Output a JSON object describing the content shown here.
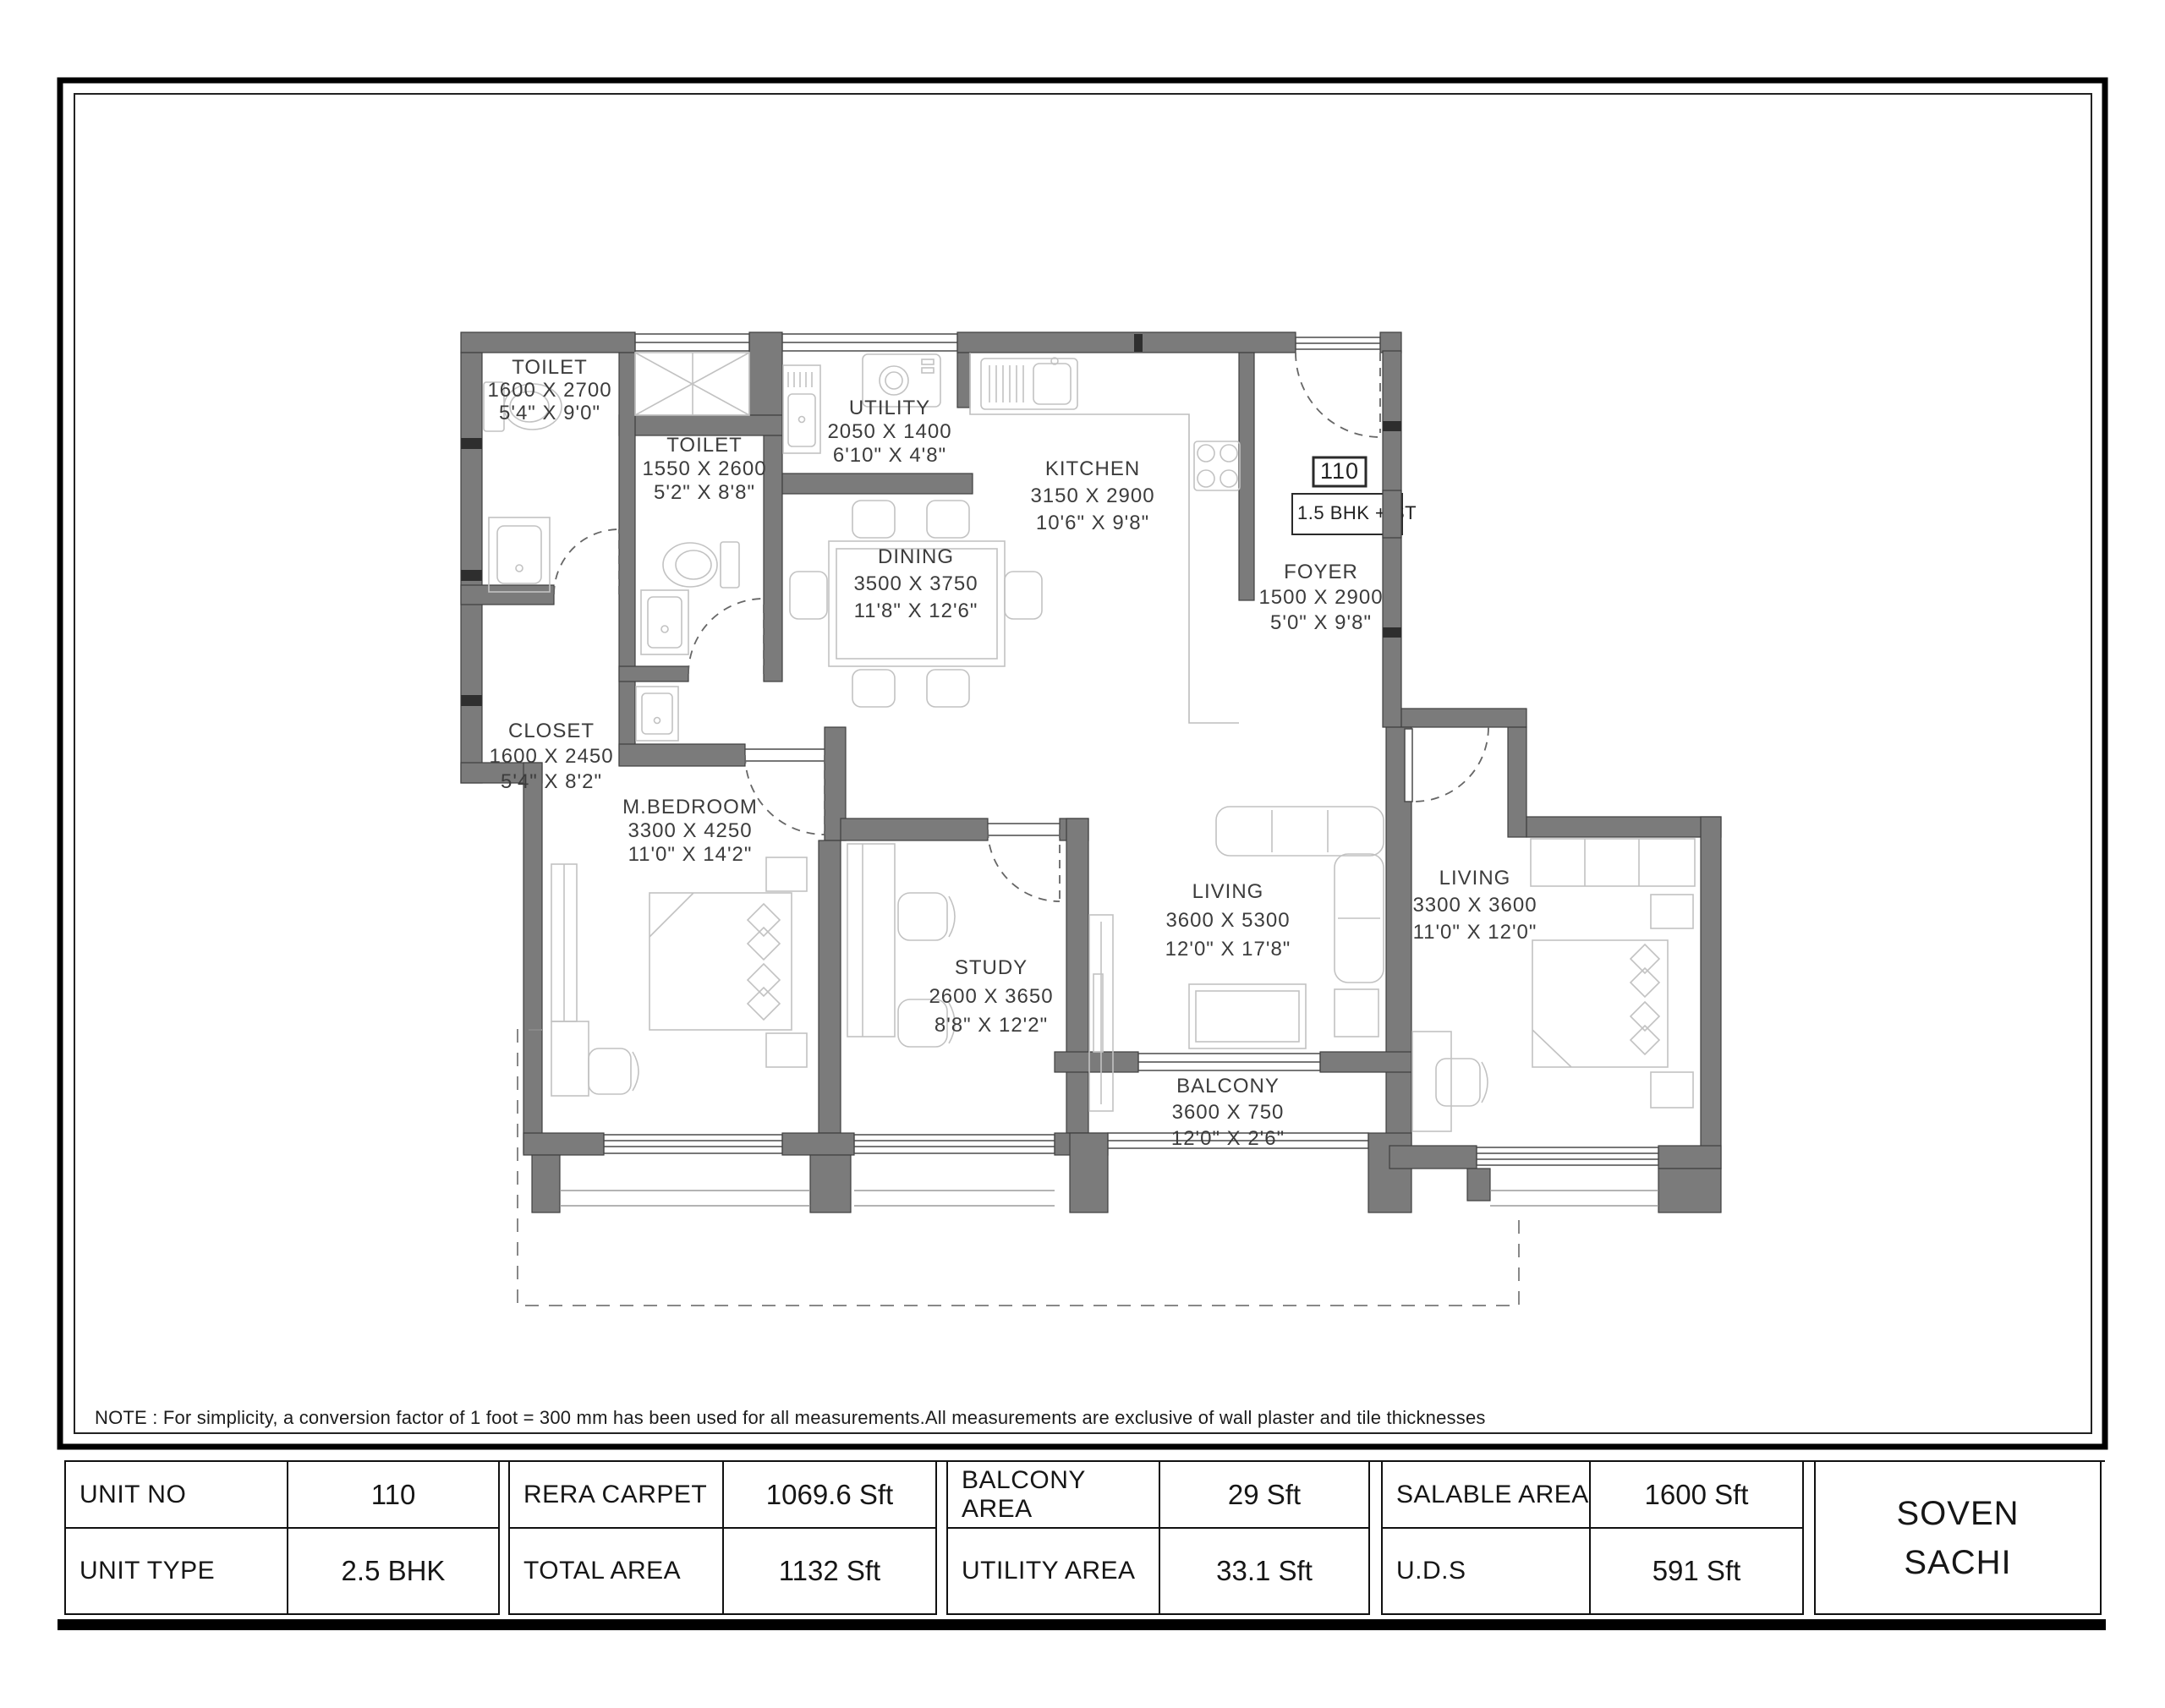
{
  "plan": {
    "unit_badge": "110",
    "unit_config": "1.5 BHK + ST",
    "rooms": [
      {
        "name": "TOILET",
        "size_mm": "1600 X 2700",
        "size_ft": "5'4\" X 9'0\""
      },
      {
        "name": "TOILET",
        "size_mm": "1550 X 2600",
        "size_ft": "5'2\" X 8'8\""
      },
      {
        "name": "UTILITY",
        "size_mm": "2050 X 1400",
        "size_ft": "6'10\" X 4'8\""
      },
      {
        "name": "KITCHEN",
        "size_mm": "3150 X 2900",
        "size_ft": "10'6\" X 9'8\""
      },
      {
        "name": "DINING",
        "size_mm": "3500 X 3750",
        "size_ft": "11'8\" X 12'6\""
      },
      {
        "name": "FOYER",
        "size_mm": "1500 X 2900",
        "size_ft": "5'0\" X 9'8\""
      },
      {
        "name": "CLOSET",
        "size_mm": "1600 X 2450",
        "size_ft": "5'4\" X 8'2\""
      },
      {
        "name": "M.BEDROOM",
        "size_mm": "3300 X 4250",
        "size_ft": "11'0\" X 14'2\""
      },
      {
        "name": "STUDY",
        "size_mm": "2600 X 3650",
        "size_ft": "8'8\" X 12'2\""
      },
      {
        "name": "LIVING",
        "size_mm": "3600 X 5300",
        "size_ft": "12'0\" X 17'8\""
      },
      {
        "name": "LIVING",
        "size_mm": "3300 X 3600",
        "size_ft": "11'0\" X 12'0\""
      },
      {
        "name": "BALCONY",
        "size_mm": "3600 X 750",
        "size_ft": "12'0\" X 2'6\""
      }
    ],
    "note": "NOTE : For simplicity, a conversion factor of 1 foot = 300 mm has been used for all measurements.All measurements are exclusive of wall plaster and tile thicknesses"
  },
  "table": {
    "groups": [
      {
        "label": "UNIT NO",
        "value": "110",
        "label2": "UNIT TYPE",
        "value2": "2.5 BHK"
      },
      {
        "label": "RERA CARPET",
        "value": "1069.6 Sft",
        "label2": "TOTAL AREA",
        "value2": "1132 Sft"
      },
      {
        "label": "BALCONY AREA",
        "value": "29 Sft",
        "label2": "UTILITY AREA",
        "value2": "33.1 Sft"
      },
      {
        "label": "SALABLE AREA",
        "value": "1600 Sft",
        "label2": "U.D.S",
        "value2": "591 Sft"
      }
    ],
    "brand": {
      "line1": "SOVEN",
      "line2": "SACHI"
    }
  },
  "colors": {
    "wall": "#7b7b7b",
    "wall_outline": "#3f3f3f",
    "fixture_line": "#c2c2c2",
    "text": "#3c3c3c",
    "frame": "#000000"
  }
}
